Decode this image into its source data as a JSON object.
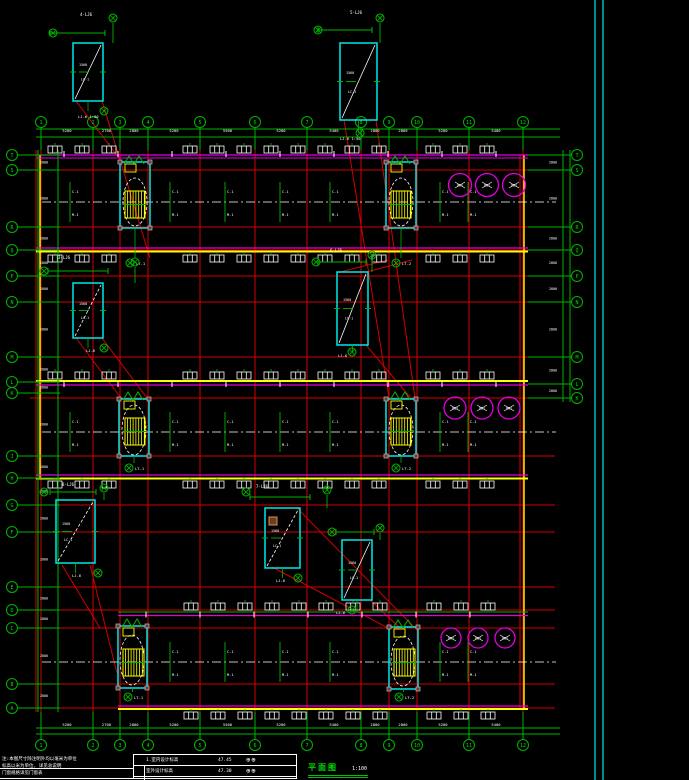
{
  "title_block": {
    "notes": [
      "注:本图尺寸除注明外均以毫米为单位",
      "标高以米为单位, 详见总说明",
      "门窗规格详见门窗表"
    ],
    "table": {
      "rows": [
        {
          "label": "1.室内设计标高",
          "value": "47.45",
          "symbols": "⊕⊕"
        },
        {
          "label": "室外设计标高",
          "value": "47.30",
          "symbols": "⊕⊕"
        },
        {
          "label": "",
          "value": "",
          "symbols": "⊕⊕"
        }
      ]
    },
    "title": {
      "text": "平面图",
      "scale": "1:100",
      "subtext": "注:1 做法详见说明",
      "symbols": "⊕⊕ ⊕—"
    }
  },
  "drawing": {
    "colors": {
      "grid": "#00b400",
      "gtxt": "#00e000",
      "red": "#d40000",
      "mag": "#e000e0",
      "yel": "#ffff00",
      "cyn": "#00e8e8",
      "wht": "#ffffff",
      "gry": "#c9a0a0",
      "org": "#d89050"
    },
    "cols": {
      "xs": [
        41,
        93,
        120,
        148,
        200,
        255,
        307,
        361,
        389,
        417,
        469,
        523
      ],
      "labels": [
        "1",
        "2",
        "3",
        "4",
        "5",
        "6",
        "7",
        "8",
        "9",
        "10",
        "11",
        "12"
      ],
      "topY": 122,
      "botY": 745,
      "dims": [
        "5200",
        "2700",
        "2800",
        "5200",
        "5500",
        "5200",
        "5400",
        "2800",
        "2800",
        "5200",
        "5400"
      ]
    },
    "rowsLeft": [
      [
        155,
        "T"
      ],
      [
        170,
        "S"
      ],
      [
        227,
        "R"
      ],
      [
        250,
        "Q"
      ],
      [
        276,
        "P"
      ],
      [
        302,
        "N"
      ],
      [
        357,
        "M"
      ],
      [
        382,
        "L"
      ],
      [
        393,
        "K"
      ],
      [
        456,
        "J"
      ],
      [
        478,
        "H"
      ],
      [
        505,
        "G"
      ],
      [
        532,
        "F"
      ],
      [
        587,
        "E"
      ],
      [
        610,
        "D"
      ],
      [
        628,
        "C"
      ],
      [
        684,
        "B"
      ],
      [
        708,
        "A"
      ]
    ],
    "rowsRight": [
      [
        155,
        "T"
      ],
      [
        170,
        "S"
      ],
      [
        227,
        "R"
      ],
      [
        250,
        "Q"
      ],
      [
        276,
        "P"
      ],
      [
        302,
        "N"
      ],
      [
        357,
        "M"
      ],
      [
        384,
        "L"
      ],
      [
        398,
        "K"
      ]
    ],
    "redH": [
      170,
      227,
      250,
      276,
      302,
      357,
      398,
      456,
      505,
      532,
      587,
      610,
      628,
      684,
      708
    ],
    "strips": [
      {
        "x": 36,
        "w": 492,
        "top": 155,
        "mag2": 158,
        "botM": 248,
        "botY": 251.5,
        "center": 202,
        "winTop": 146,
        "winBot": 255,
        "yellowTop": null
      },
      {
        "x": 36,
        "w": 492,
        "top": 385,
        "mag2": null,
        "botM": 475,
        "botY": 478.5,
        "center": 432,
        "winTop": 372,
        "winBot": 481,
        "yellowTop": 381
      },
      {
        "x": 118,
        "w": 410,
        "top": 615.5,
        "mag2": null,
        "botM": 706,
        "botY": 709,
        "center": 662,
        "winTop": 603,
        "winBot": 712,
        "yellowTop": null,
        "greenTop": 612
      }
    ],
    "stairs": [
      {
        "bx": 120,
        "by": 162,
        "bw": 30,
        "bh": 66,
        "tx": 125,
        "ty": 191,
        "tw": 20,
        "th": 27,
        "ex": 135,
        "ey": 202,
        "rx": 12,
        "ry": 24,
        "mx": 124,
        "my": 156,
        "iy": 263,
        "lab": "LT-1"
      },
      {
        "bx": 386,
        "by": 162,
        "bw": 30,
        "bh": 66,
        "tx": 391,
        "ty": 191,
        "tw": 20,
        "th": 27,
        "ex": 401,
        "ey": 202,
        "rx": 12,
        "ry": 24,
        "mx": 390,
        "my": 156,
        "iy": 263,
        "lab": "LT-2"
      },
      {
        "bx": 119,
        "by": 399,
        "bw": 30,
        "bh": 57,
        "tx": 125,
        "ty": 418,
        "tw": 20,
        "th": 27,
        "ex": 134,
        "ey": 430,
        "rx": 12,
        "ry": 25,
        "mx": 123,
        "my": 392,
        "iy": 468,
        "lab": "LT-1"
      },
      {
        "bx": 386,
        "by": 399,
        "bw": 30,
        "bh": 57,
        "tx": 391,
        "ty": 418,
        "tw": 20,
        "th": 27,
        "ex": 401,
        "ey": 430,
        "rx": 12,
        "ry": 25,
        "mx": 390,
        "my": 392,
        "iy": 468,
        "lab": "LT-2"
      },
      {
        "bx": 118,
        "by": 626,
        "bw": 29,
        "bh": 62,
        "tx": 123,
        "ty": 649,
        "tw": 21,
        "th": 27,
        "ex": 132,
        "ey": 660,
        "rx": 12,
        "ry": 25,
        "mx": 122,
        "my": 619,
        "iy": 697,
        "lab": "LT-1"
      },
      {
        "bx": 389,
        "by": 627,
        "bw": 29,
        "bh": 62,
        "tx": 394,
        "ty": 649,
        "tw": 21,
        "th": 27,
        "ex": 403,
        "ey": 661,
        "rx": 12,
        "ry": 25,
        "mx": 393,
        "my": 620,
        "iy": 697,
        "lab": "LT-2"
      }
    ],
    "tanks": [
      {
        "cy": 185,
        "r": 11.5,
        "xs": [
          460,
          487,
          514
        ]
      },
      {
        "cy": 408,
        "r": 11,
        "xs": [
          455,
          482,
          509
        ]
      },
      {
        "cy": 638,
        "r": 10,
        "xs": [
          451,
          478,
          505
        ]
      }
    ],
    "details": [
      {
        "x": 73,
        "y": 43,
        "w": 30,
        "h": 58,
        "dd": false,
        "dimY": 33,
        "d1": 50,
        "d2": 105,
        "c1": [
          53,
          33
        ],
        "c2": [
          113,
          18
        ],
        "tt": "4-LJ6",
        "ttx": 80,
        "tty": 16,
        "bid": [
          104,
          111
        ],
        "bl": "LJ-6 1:50",
        "blx": 78,
        "bly": 118
      },
      {
        "x": 340,
        "y": 43,
        "w": 37,
        "h": 77,
        "dd": false,
        "dimY": 30,
        "d1": 318,
        "d2": 372,
        "c1": [
          318,
          30
        ],
        "c2": [
          380,
          18
        ],
        "tt": "5-LJ6",
        "ttx": 350,
        "tty": 14,
        "bid": [
          360,
          133
        ],
        "bl": "LJ-6 1:50",
        "blx": 340,
        "bly": 140
      },
      {
        "x": 73,
        "y": 283,
        "w": 30,
        "h": 55,
        "dd": true,
        "dimY": 271,
        "d1": 48,
        "d2": 108,
        "c1": [
          44,
          271
        ],
        "c2": [
          135,
          262
        ],
        "tt": "3-LJ6",
        "ttx": 58,
        "tty": 259,
        "bid": [
          104,
          348
        ],
        "bl": "LJ-6",
        "blx": 86,
        "bly": 352
      },
      {
        "x": 337,
        "y": 272,
        "w": 31,
        "h": 73,
        "dd": false,
        "dimY": 262,
        "d1": 318,
        "d2": 366,
        "c1": [
          316,
          262
        ],
        "c2": [
          372,
          255
        ],
        "tt": "6-LJ6",
        "ttx": 330,
        "tty": 252,
        "bid": [
          352,
          352
        ],
        "bl": "LJ-6",
        "blx": 338,
        "bly": 357
      },
      {
        "x": 56,
        "y": 500,
        "w": 39,
        "h": 63,
        "dd": true,
        "dimY": 492,
        "d1": 50,
        "d2": 96,
        "c1": [
          44,
          492
        ],
        "c2": [
          104,
          488
        ],
        "tt": "8-LJ6",
        "ttx": 62,
        "tty": 486,
        "bid": [
          98,
          573
        ],
        "bl": "LJ-6",
        "blx": 72,
        "bly": 577
      },
      {
        "x": 265,
        "y": 508,
        "w": 35,
        "h": 60,
        "dd": true,
        "dimY": 497,
        "d1": 250,
        "d2": 310,
        "c1": [
          246,
          492
        ],
        "c2": [
          327,
          490
        ],
        "tt": "7-LJ6",
        "ttx": 256,
        "tty": 488,
        "bid": [
          298,
          578
        ],
        "bl": "LJ-6",
        "blx": 276,
        "bly": 582,
        "or": [
          269,
          517
        ]
      },
      {
        "x": 342,
        "y": 540,
        "w": 30,
        "h": 60,
        "dd": false,
        "dimY": 532,
        "d1": 336,
        "d2": 374,
        "c1": [
          332,
          532
        ],
        "c2": [
          380,
          528
        ],
        "tt": "",
        "ttx": 348,
        "tty": 526,
        "bid": [
          352,
          610
        ],
        "bl": "LJ-6",
        "blx": 336,
        "bly": 614
      }
    ],
    "diagonals": [
      [
        76,
        101,
        122,
        162
      ],
      [
        102,
        101,
        150,
        258
      ],
      [
        344,
        120,
        389,
        398
      ],
      [
        376,
        120,
        415,
        398
      ],
      [
        76,
        338,
        121,
        398
      ],
      [
        102,
        338,
        147,
        398
      ],
      [
        340,
        272,
        388,
        260
      ],
      [
        366,
        272,
        412,
        260
      ],
      [
        366,
        345,
        410,
        397
      ],
      [
        297,
        508,
        415,
        628
      ],
      [
        272,
        567,
        390,
        629
      ],
      [
        370,
        600,
        400,
        628
      ],
      [
        90,
        565,
        117,
        673
      ],
      [
        62,
        565,
        100,
        628
      ]
    ],
    "interiorLabelXs": [
      70,
      170,
      225,
      280,
      330,
      440,
      468,
      496
    ],
    "border": {
      "x1": 595,
      "x2": 603
    },
    "dimRight": {
      "v1": 563,
      "v2": 570,
      "bx": 577
    },
    "dimLeft": {
      "v1": 38,
      "v2": 58,
      "bx": 12
    },
    "labels": {
      "win": "C-1",
      "door": "M-1",
      "dimv": "2800"
    }
  }
}
